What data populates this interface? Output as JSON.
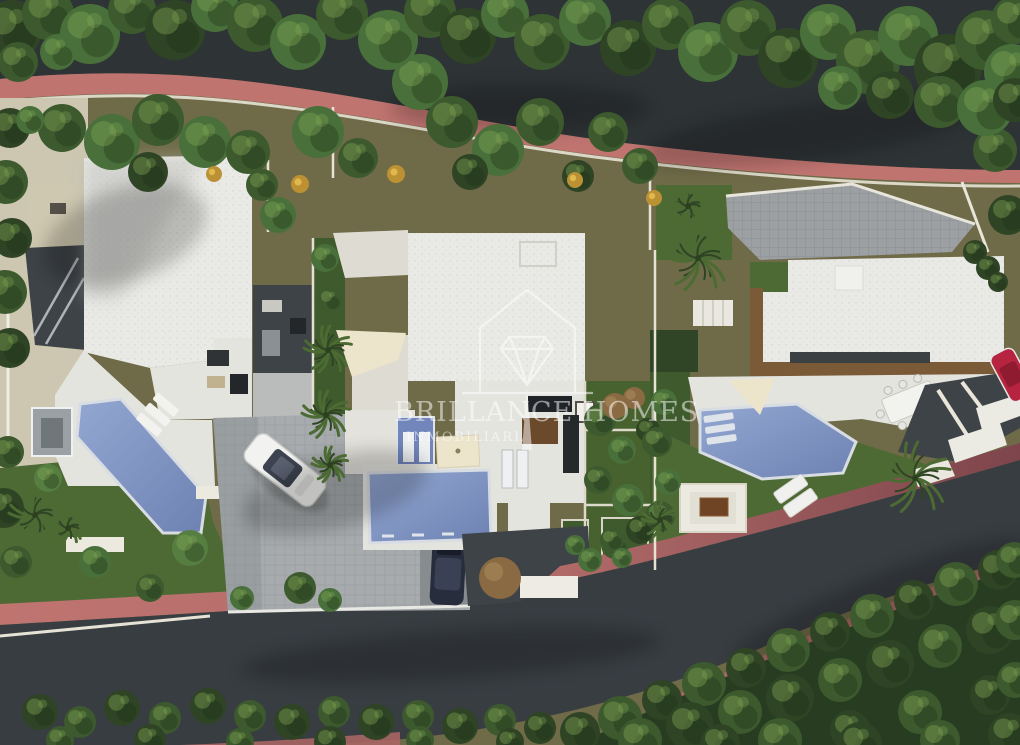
{
  "watermark": {
    "line1": "BRILLANCE HOMES",
    "line2": "INMOBILIARIA",
    "logo": "house-outline-with-brilliant-diamond-icon"
  },
  "palette": {
    "olive": "#6f6b48",
    "roadTop": "#2e3336",
    "roadBottom": "#383d42",
    "sidewalkPink": "#bf7470",
    "sidewalkMaroon": "#7e454c",
    "sidewalkLower": "#a86663",
    "lawn": "#4e6a34",
    "lawnDark": "#3f5a2c",
    "bedDark": "#2f4526",
    "hedge": "#273c20",
    "tree1": "#2f4424",
    "tree2": "#3c5a2e",
    "tree3": "#49703a",
    "tree4": "#567e41",
    "treeHighlight": "#86ab57",
    "treeShadow": "#1c2d15",
    "roofWhite": "#e9e9e5",
    "terrace": "#e4e4df",
    "walkWhite": "#dedcd2",
    "driveGray": "#a7abad",
    "driveDark": "#878c8f",
    "drive3Gray": "#9da0a2",
    "poolLight": "#8ba0cc",
    "poolDark": "#6d82b2",
    "poolRim": "#d8dce3",
    "woodDeck": "#7b5a38",
    "wallBeige": "#cdc7b1",
    "wallLine": "#e8e4d6",
    "cream": "#ece4cb",
    "anthracite": "#3e4347",
    "blueWall": "#7286bc",
    "carNavy": "#272d3d",
    "carRed": "#b72440",
    "carWhite": "#f2f2f0",
    "rustyShrub": "#8a6a42",
    "yellowShrub": "#bb9133",
    "palmGreen": "#4c6b33",
    "upperStreet": "#909294",
    "watermarkWhite": "#ffffff"
  }
}
